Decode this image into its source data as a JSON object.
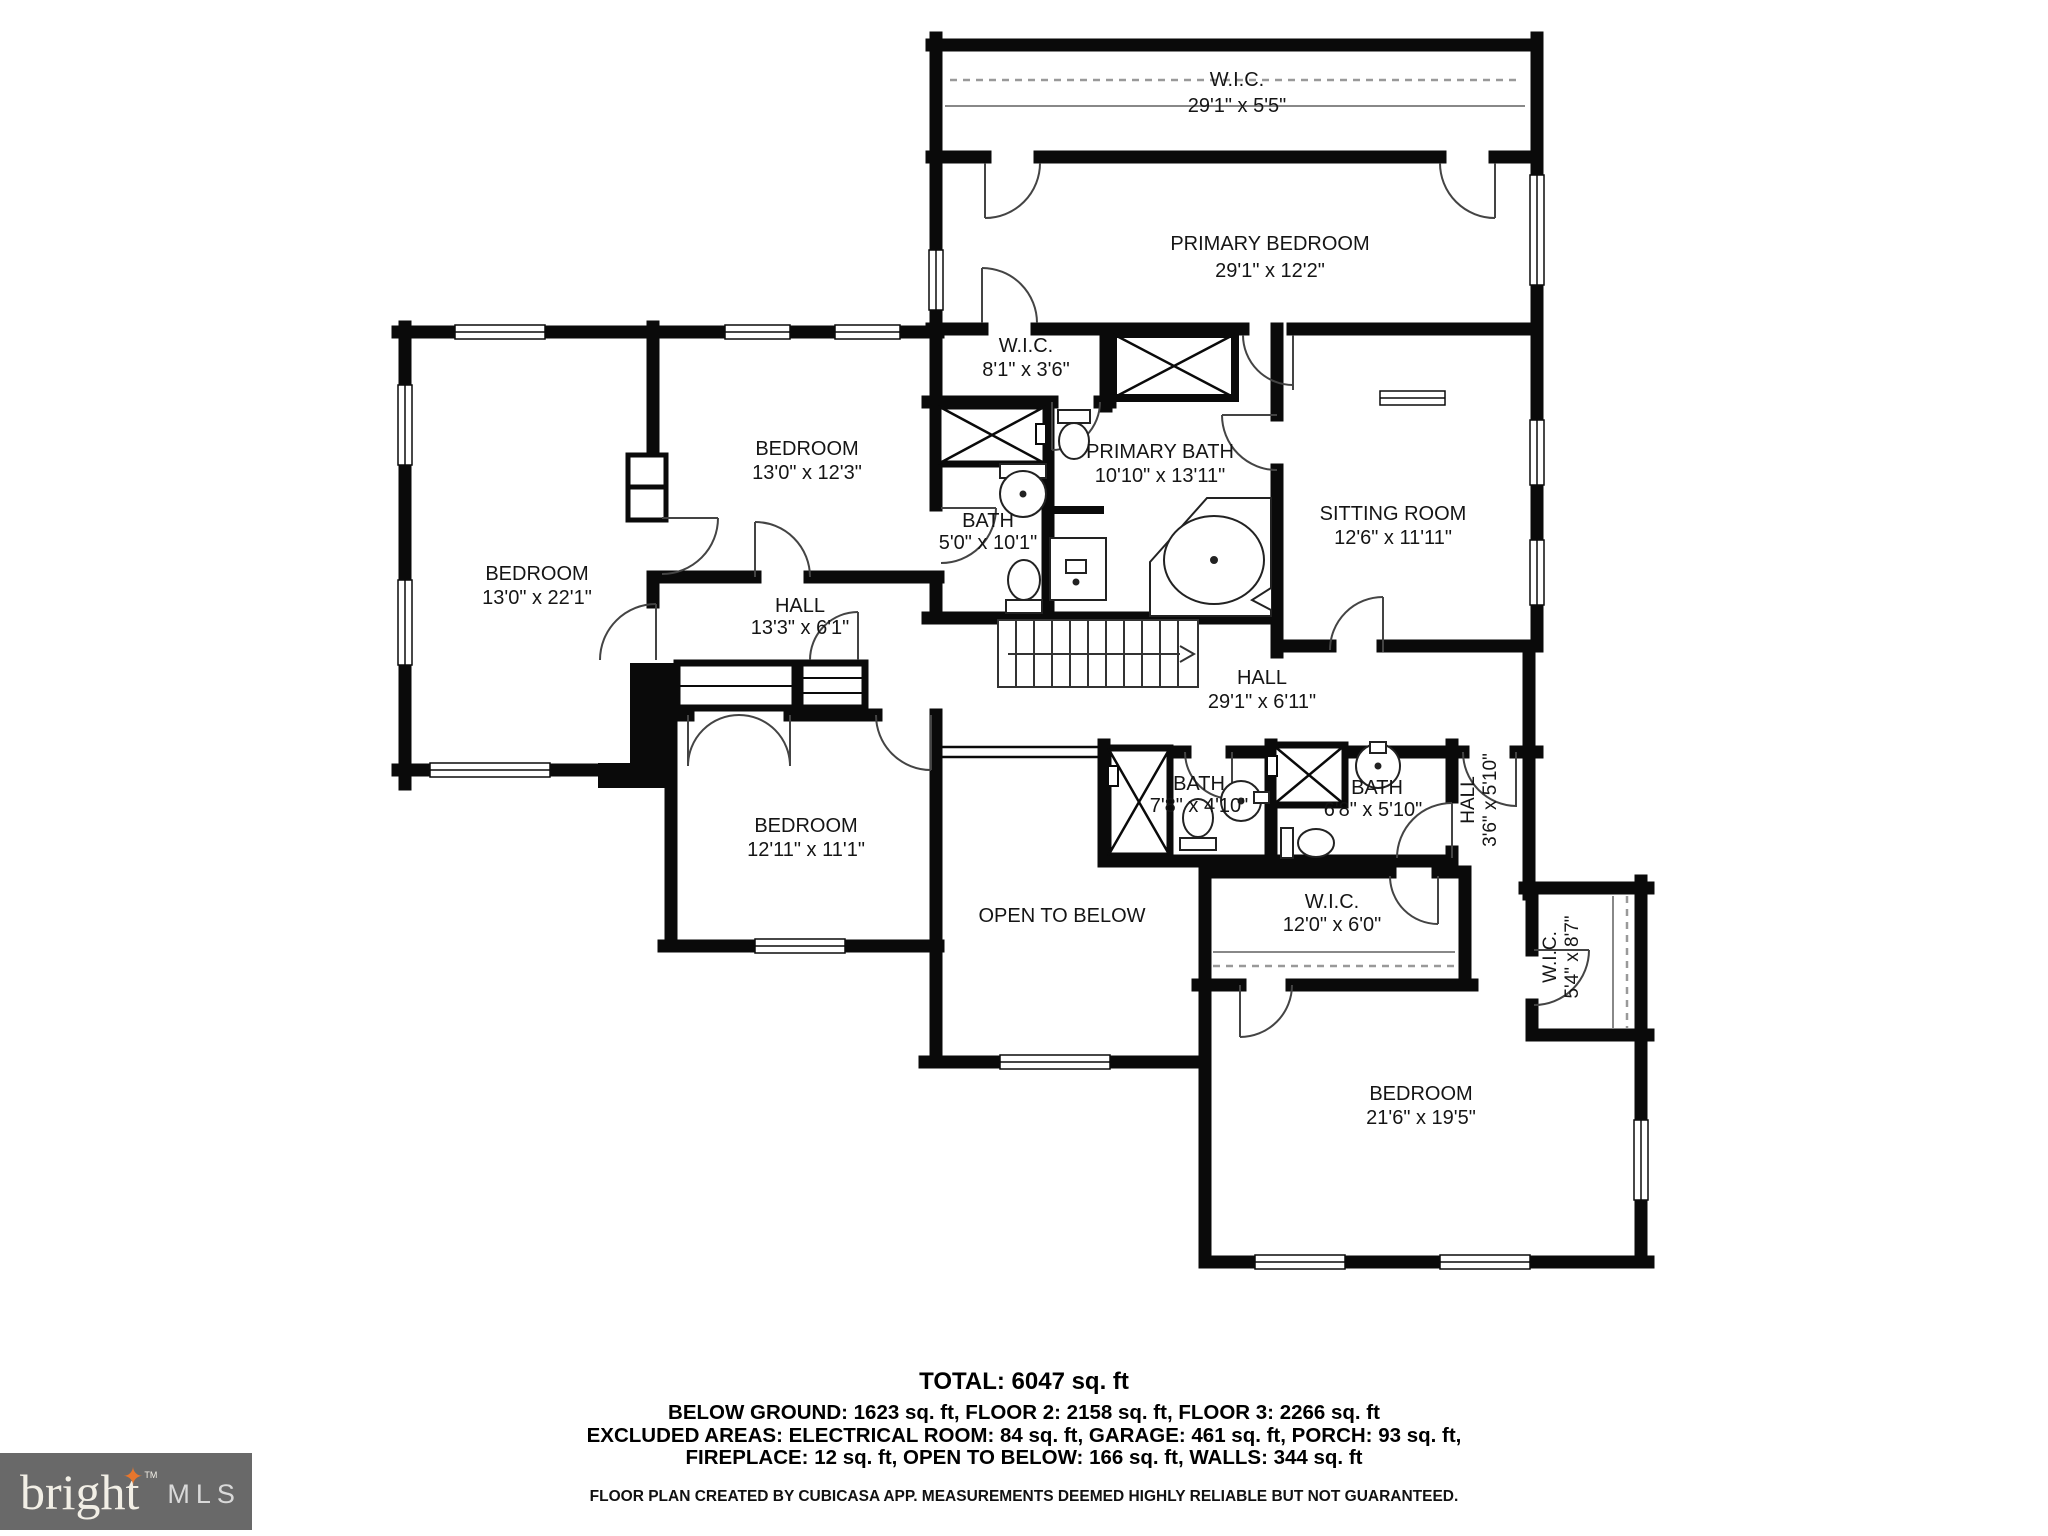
{
  "rooms": {
    "wic_top": {
      "name": "W.I.C.",
      "dims": "29'1\" x 5'5\""
    },
    "primary_bedroom": {
      "name": "PRIMARY BEDROOM",
      "dims": "29'1\" x 12'2\""
    },
    "wic_primary": {
      "name": "W.I.C.",
      "dims": "8'1\" x 3'6\""
    },
    "primary_bath": {
      "name": "PRIMARY BATH",
      "dims": "10'10\" x 13'11\""
    },
    "bedroom_mid": {
      "name": "BEDROOM",
      "dims": "13'0\" x 12'3\""
    },
    "sitting_room": {
      "name": "SITTING ROOM",
      "dims": "12'6\" x 11'11\""
    },
    "bedroom_left": {
      "name": "BEDROOM",
      "dims": "13'0\" x 22'1\""
    },
    "bath_small": {
      "name": "BATH",
      "dims": "5'0\" x 10'1\""
    },
    "hall_left": {
      "name": "HALL",
      "dims": "13'3\" x 6'1\""
    },
    "hall_main": {
      "name": "HALL",
      "dims": "29'1\" x 6'11\""
    },
    "bedroom_lower": {
      "name": "BEDROOM",
      "dims": "12'11\" x 11'1\""
    },
    "bath_1": {
      "name": "BATH",
      "dims": "7'8\" x 4'10\""
    },
    "bath_2": {
      "name": "BATH",
      "dims": "6'8\" x 5'10\""
    },
    "hall_small": {
      "name": "HALL",
      "dims": "3'6\" x 5'10\""
    },
    "open_below": {
      "name": "OPEN TO BELOW"
    },
    "wic_12": {
      "name": "W.I.C.",
      "dims": "12'0\" x 6'0\""
    },
    "wic_54": {
      "name": "W.I.C.",
      "dims": "5'4\" x 8'7\""
    },
    "bedroom_big": {
      "name": "BEDROOM",
      "dims": "21'6\" x 19'5\""
    }
  },
  "summary": {
    "total": "TOTAL: 6047 sq. ft",
    "line1": "BELOW GROUND: 1623 sq. ft, FLOOR 2: 2158 sq. ft, FLOOR 3: 2266 sq. ft",
    "line2": "EXCLUDED AREAS: ELECTRICAL ROOM: 84 sq. ft, GARAGE: 461 sq. ft, PORCH: 93 sq. ft,",
    "line3": "FIREPLACE: 12 sq. ft, OPEN TO BELOW: 166 sq. ft, WALLS: 344 sq. ft"
  },
  "footer": {
    "disclaimer": "FLOOR PLAN CREATED BY CUBICASA APP. MEASUREMENTS DEEMED HIGHLY RELIABLE BUT NOT GUARANTEED."
  },
  "logo": {
    "brand": "bright",
    "tm": "TM",
    "mls": "MLS",
    "bg_color": "#696969",
    "star_color": "#e8762c"
  },
  "colors": {
    "walls": "#0a0a0a",
    "background": "#ffffff"
  }
}
